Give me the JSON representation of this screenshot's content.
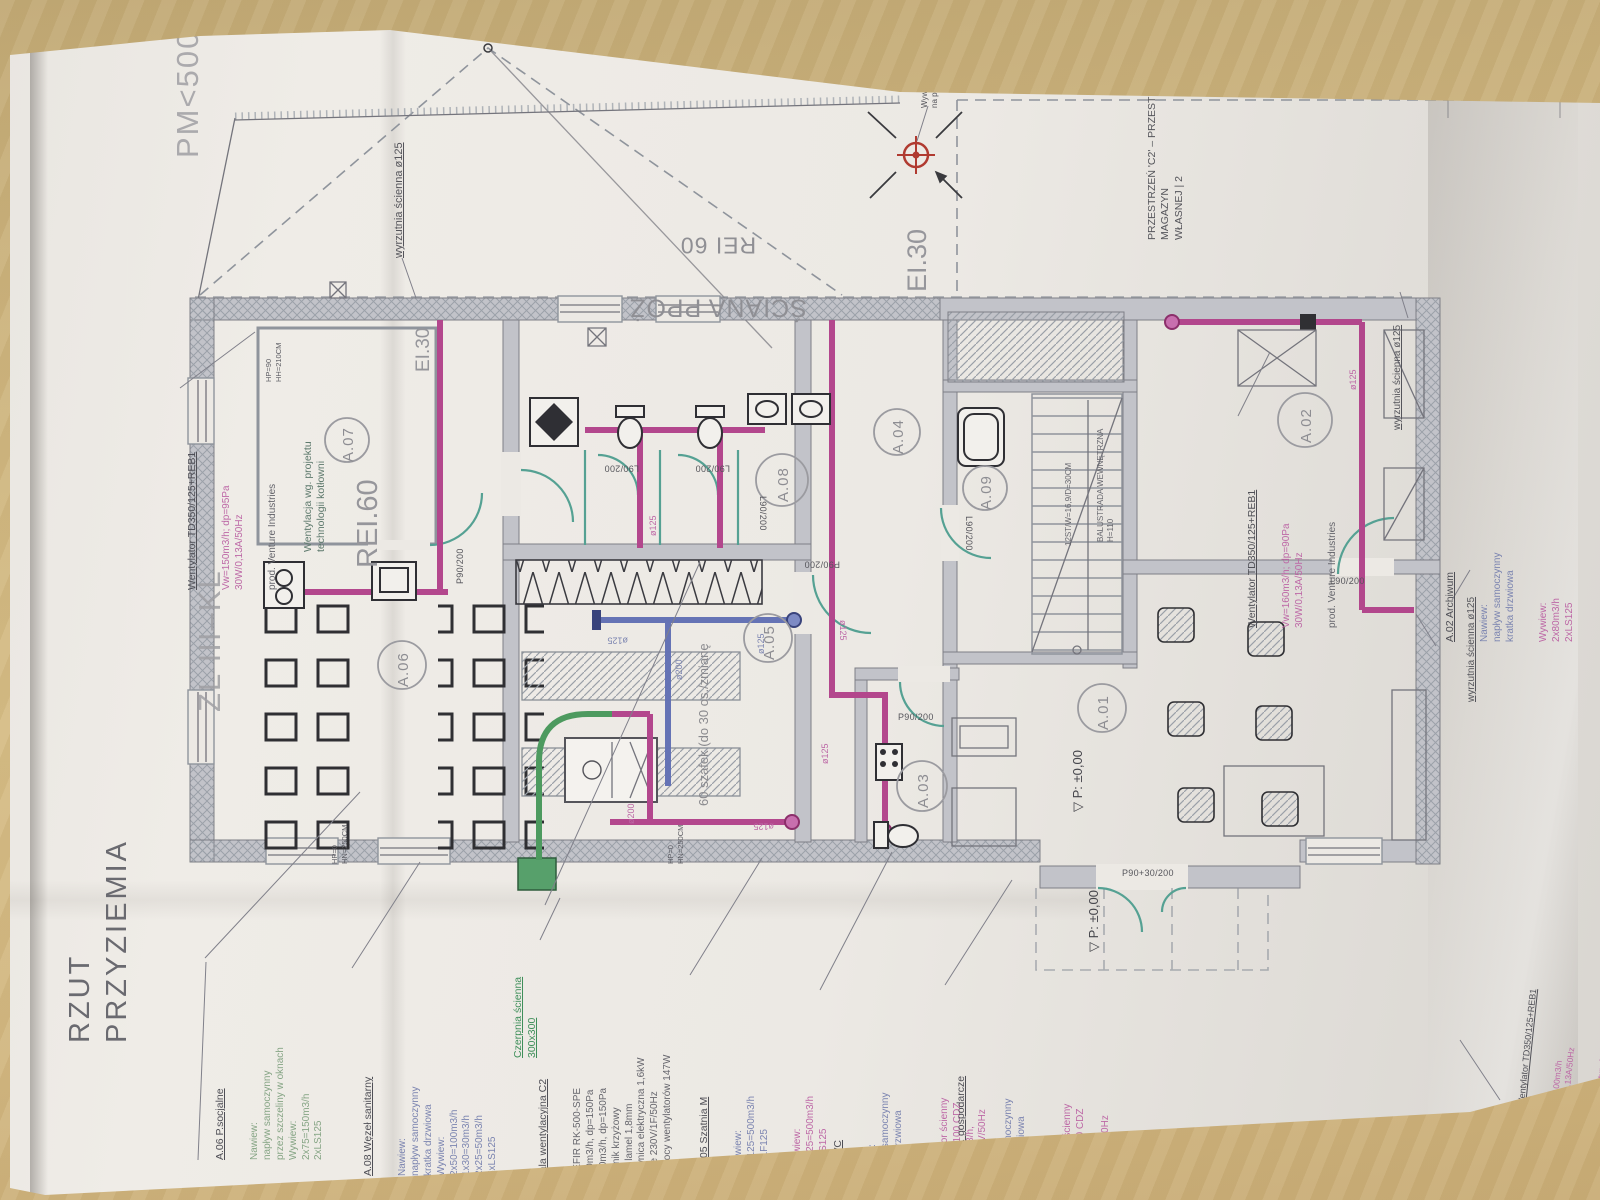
{
  "title": "RZUT PRZYZIEMIA",
  "boundary": {
    "pm": "PM<500M",
    "zl": "ZL III–KL",
    "przestrzen": "PRZESTRZEŃ 'C2' – PRZESTRZEŃ MAGAZYN\nWŁASNEJ | 2",
    "wywietrzak": "Wywietrzak dach.\nna podstawie d.",
    "sciana_ppoz": "ŚCIANA PPOŻ",
    "sciana_rei": "REI 60",
    "ei30_mid": "EI.30",
    "ei30_left": "EI.30"
  },
  "rooms": {
    "a01": "A.01",
    "a02": "A.02",
    "a03": "A.03",
    "a04": "A.04",
    "a05": "A.05",
    "a06": "A.06",
    "a07": "A.07",
    "a08": "A.08",
    "a09": "A.09"
  },
  "plan_labels": {
    "rei60_room": "REI.60",
    "a07_note": "Wentylacja wg. projektu\ntechnologii kotłowni",
    "wyrzutnia": "wyrzutnia ścienna ø125",
    "szafek": "60 szafek (do 30 os./zmianę",
    "stairs": "12ST/W=16,9/D=30CM",
    "balustrade": "BALUSTRADA WEWNĘTRZNA H=110",
    "level": "▽ P: ±0,00",
    "hp_a07": "HP=90\nHH=210CM",
    "hp_a06": "HP=0\nHN=250CM",
    "hp_a05": "HP=0\nHN=250CM"
  },
  "doors": {
    "d1": "P90/200",
    "d2": "L90/200",
    "d3": "L90/200",
    "d4": "L90/200",
    "d5": "P90/200",
    "d6": "P90/200",
    "d7": "L90/200",
    "d8": "P90+30/200",
    "d9": "L90/200"
  },
  "ducts": {
    "dia125": "ø125",
    "dia200": "ø200"
  },
  "fans": {
    "tl": {
      "header": "Wentylator TD350/125+REB1",
      "spec": "Vw=150m3/h; dp=95Pa\n30W/0,13A/50Hz",
      "prod": "prod. Venture Industries"
    },
    "a02": {
      "header": "Wentylator TD350/125+REB1",
      "spec": "Vw=160m3/h; dp=90Pa\n30W/0,13A/50Hz",
      "prod": "prod. Venture Industries"
    },
    "br": {
      "header": "Wentylator TD350/125+REB1",
      "spec": "Vw=100m3/h\n30W/0,13A/50Hz",
      "prod": "prod. Venture Industries"
    }
  },
  "notes": {
    "a06": {
      "header": "A.06 P.socjalne",
      "body": "Nawiew:\nnapływ samoczynny\nprzez szczeliny w oknach\nWywiew:\n2x75=150m3/h\n2xLS125"
    },
    "a08": {
      "header": "A.08 Węzeł sanitarny",
      "body": "Nawiew:\nnapływ samoczynny\nkratka drzwiowa\nWywiew:\n2x50=100m3/h\n1x30=30m3/h\n2x25=50m3/h\n5xLS125"
    },
    "czerpnia": {
      "body": "Czerpnia ścienna\n300x300"
    },
    "centrala": {
      "header": "Centrala wentylacyjna C2",
      "body": "EKOZEFIR RK-500-SPE\nVn=500m3/h, dp=150Pa\nVw=500m3/h, dp=150Pa\nwymiennik krzyżowy\nrozstaw lamel 1,8mm\nnagrzewnica elektryczna 1,6kW\nZasilanie 230V/1F/50Hz\nPobór mocy wentylatorów 147W"
    },
    "a05": {
      "header": "A.05 Szatnia M",
      "supply": "Nawiew:\n4x125=500m3/h\n4xLF125",
      "exhaust": "Wywiew:\n4x125=500m3/h\n4xLS125"
    },
    "a03": {
      "header": "A.03 WC",
      "supply": "Nawiew:\nnapływ samoczynny\nkratka drzwiowa",
      "exhaust": "Wywiew:\nWentylator ścienny\nDECOR-100 CDZ\nVw=50m3/h,\n13W/230V/50Hz"
    },
    "a09": {
      "header": "A.09 Pom. gospodarcze",
      "supply": "Nawiew:\nnapływ samoczynny\nkratka drzwiowa",
      "exhaust": "Wywiew:\nWentylator ścienny\nDECOR-100 CDZ\nVw=30m3/h,\n13W/230V/50Hz"
    },
    "a02": {
      "header": "A.02 Archiwum",
      "supply": "Nawiew:\nnapływ samoczynny\nkratka drzwiowa",
      "exhaust": "Wywiew:\n2x80m3/h\n2xLS125"
    }
  }
}
